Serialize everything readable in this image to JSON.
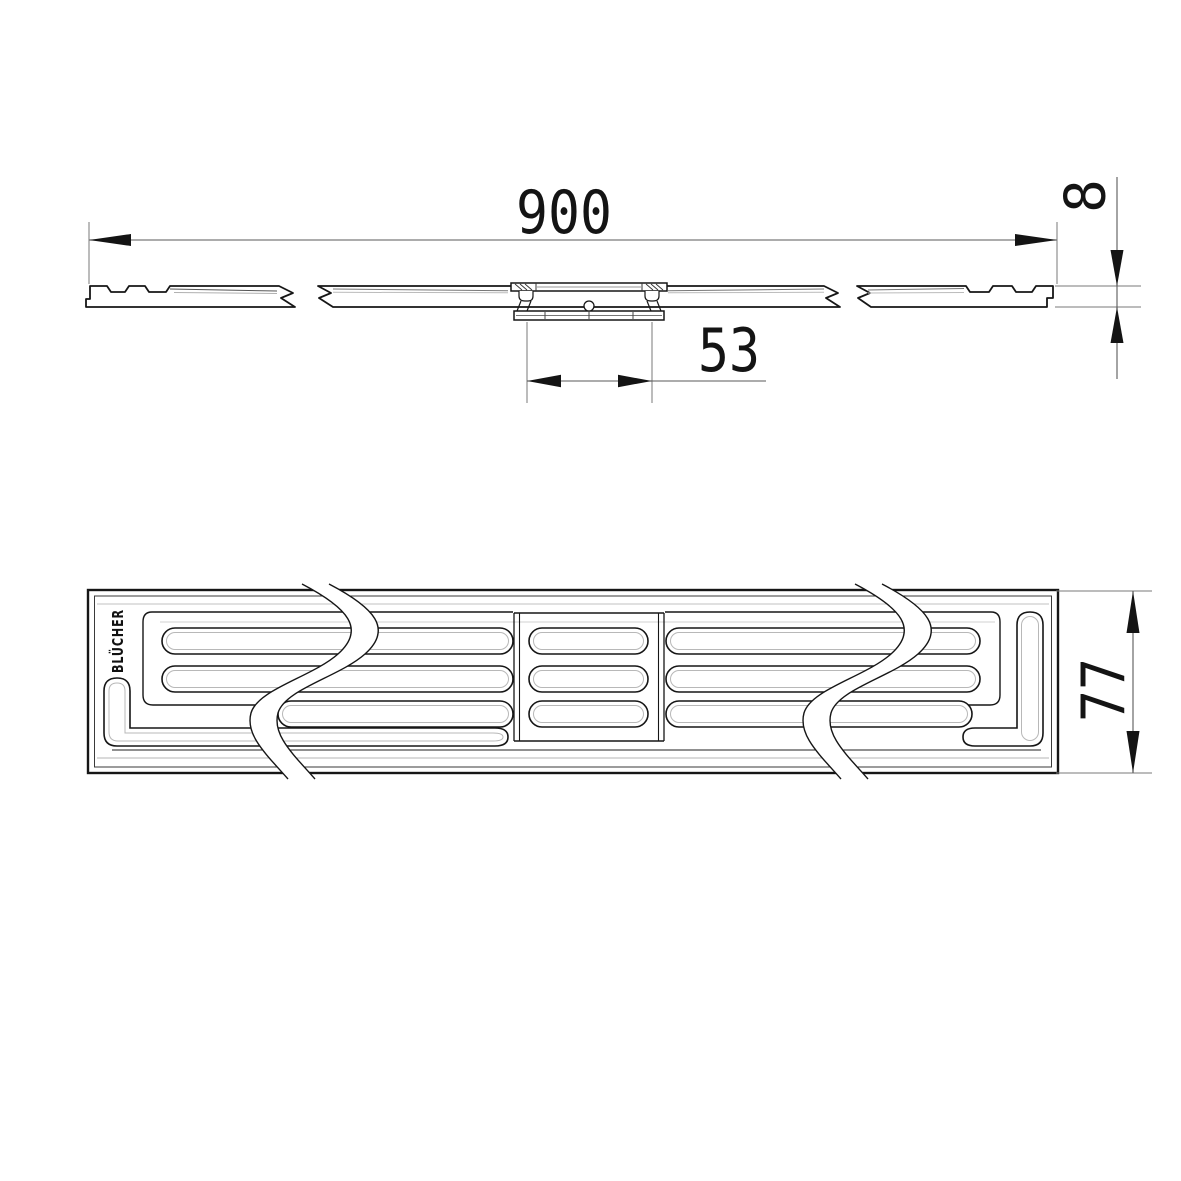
{
  "drawing": {
    "brand_label": "BLÜCHER",
    "dimensions": {
      "overall_length": "900",
      "edge_thickness": "8",
      "outlet_width": "53",
      "grate_width": "77"
    },
    "colors": {
      "line": "#161616",
      "dimension_line": "#6e6e6e",
      "background": "#ffffff"
    }
  }
}
